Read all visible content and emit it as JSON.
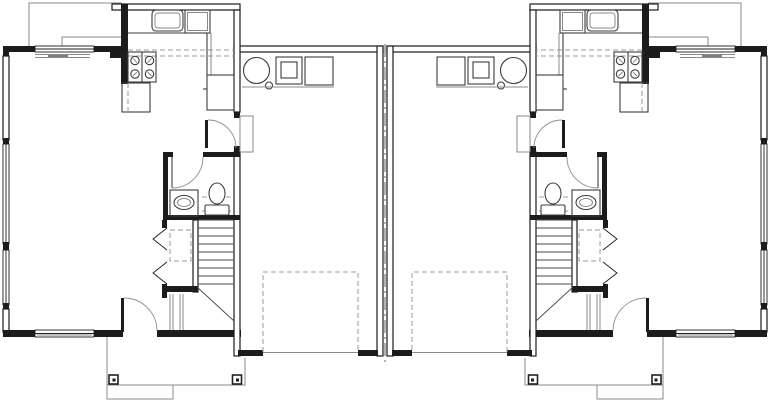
{
  "plan": {
    "kind": "duplex main-floor plan, two mirrored units sharing a central party wall",
    "unit_count": 2,
    "mirrored": true,
    "rooms_per_unit": [
      "living-dining-room",
      "kitchen",
      "hallway",
      "half-bathroom",
      "entry-closet",
      "staircase",
      "foyer",
      "garage",
      "front-porch"
    ],
    "kitchen_fixtures": [
      "double-basin-sink",
      "counter-appliance-box",
      "range-with-4-burners",
      "base-cabinet-dishwasher",
      "refrigerator",
      "upper-cabinets-dashed"
    ],
    "bathroom_fixtures": [
      "vanity-with-oval-sink",
      "toilet"
    ],
    "garage_fixtures": [
      "water-heater",
      "furnace",
      "utility-box",
      "equipment-platform",
      "overhead-garage-door-dashed-track",
      "door-threshold",
      "entry-step"
    ],
    "exterior_features": [
      "windows",
      "front-entry-door",
      "porch-with-posts",
      "porch-step",
      "roof-overhang-lines",
      "party-wall-centerline"
    ],
    "stair_features": [
      "treads",
      "break-line",
      "lower-run-rails"
    ],
    "closet_features": [
      "bifold-doors",
      "dashed-shelf"
    ]
  },
  "colors": {
    "background": "#ffffff",
    "wall": "#1c1c1c",
    "fixture": "#3d3d3d",
    "light_line": "#8a8a8a",
    "dashed_line": "#9a9a9a",
    "centerline": "#666666"
  }
}
